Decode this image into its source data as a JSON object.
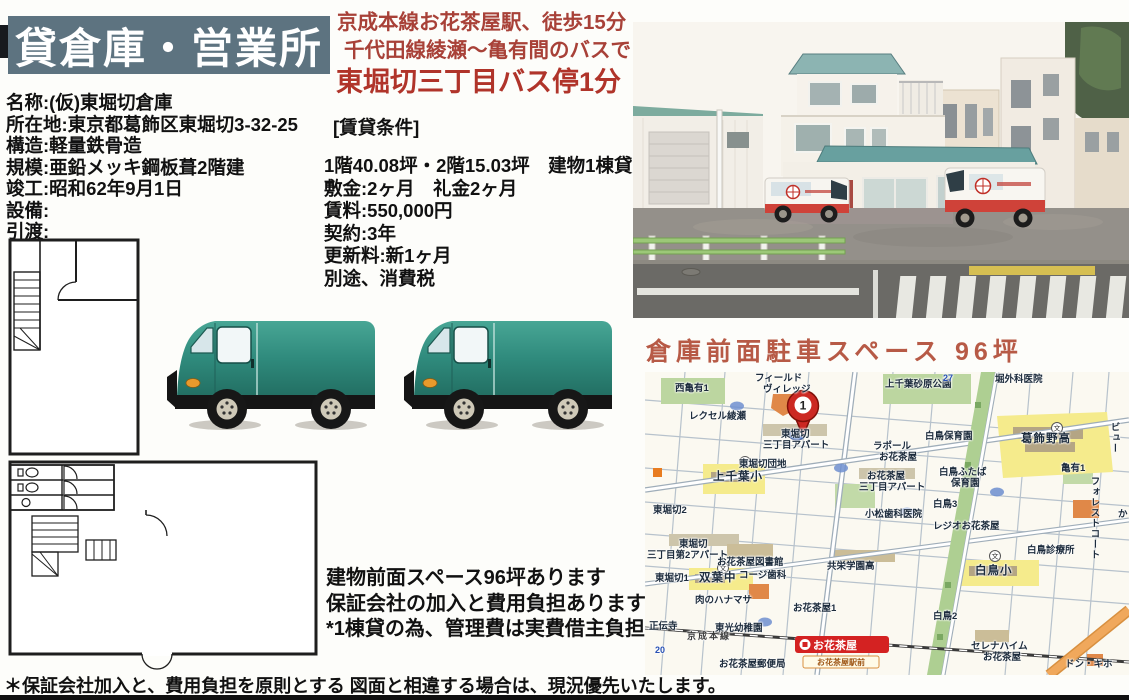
{
  "colors": {
    "banner_bg": "#5d7380",
    "heading_red": "#a84138",
    "title_red": "#b0342a",
    "parking_red": "#b75a46",
    "station_red": "#d42222",
    "van_teal": "#2f8a7c",
    "roof_teal": "#6ba09f"
  },
  "banner": {
    "title": "貸倉庫・営業所"
  },
  "property": {
    "lines": [
      "名称:(仮)東堀切倉庫",
      "所在地:東京都葛飾区東堀切3-32-25",
      "構造:軽量鉄骨造",
      "規模:亜鉛メッキ鋼板葺2階建",
      "竣工:昭和62年9月1日",
      "設備:",
      "引渡:"
    ]
  },
  "access": {
    "line1": "京成本線お花茶屋駅、徒歩15分",
    "line2": "千代田線綾瀬～亀有間のバスで",
    "line3": "東堀切三丁目バス停1分",
    "lease_heading": "[賃貸条件]"
  },
  "lease": {
    "lines": [
      "1階40.08坪・2階15.03坪　建物1棟貸",
      "敷金:2ヶ月　礼金2ヶ月",
      "賃料:550,000円",
      "契約:3年",
      "更新料:新1ヶ月",
      "別途、消費税"
    ]
  },
  "notes": {
    "lines": [
      "建物前面スペース96坪あります",
      "保証会社の加入と費用負担あります",
      "*1棟貸の為、管理費は実費借主負担"
    ]
  },
  "parking_title": "倉庫前面駐車スペース 96坪",
  "footer": "＊保証会社加入と、費用負担を原則とする 図面と相違する場合は、現況優先いたします。",
  "map": {
    "marker": "1",
    "station_label": "お花茶屋",
    "busstop_label": "お花茶屋駅前",
    "labels": [
      {
        "text": "西亀有1",
        "x": 30,
        "y": 12
      },
      {
        "text": "フィールド",
        "x": 110,
        "y": 2
      },
      {
        "text": "ヴィレッジ",
        "x": 118,
        "y": 13
      },
      {
        "text": "上千葉砂原公園",
        "x": 240,
        "y": 8
      },
      {
        "text": "堀外科医院",
        "x": 350,
        "y": 3
      },
      {
        "text": "レクセル綾瀬",
        "x": 44,
        "y": 40
      },
      {
        "text": "東堀切",
        "x": 136,
        "y": 58
      },
      {
        "text": "三丁目アパート",
        "x": 118,
        "y": 69
      },
      {
        "text": "東堀切団地",
        "x": 94,
        "y": 88
      },
      {
        "text": "上千葉小",
        "x": 68,
        "y": 100,
        "cls": "big"
      },
      {
        "text": "ラポール",
        "x": 228,
        "y": 70
      },
      {
        "text": "お花茶屋",
        "x": 234,
        "y": 81
      },
      {
        "text": "白鳥保育園",
        "x": 280,
        "y": 60
      },
      {
        "text": "葛飾野高",
        "x": 376,
        "y": 62,
        "cls": "big"
      },
      {
        "text": "亀有1",
        "x": 416,
        "y": 92
      },
      {
        "text": "白鳥ふたば",
        "x": 294,
        "y": 96
      },
      {
        "text": "保育園",
        "x": 306,
        "y": 107
      },
      {
        "text": "フォレストコート",
        "x": 444,
        "y": 104,
        "cls": "vert"
      },
      {
        "text": "ビュー",
        "x": 464,
        "y": 50,
        "cls": "vert"
      },
      {
        "text": "か",
        "x": 473,
        "y": 138
      },
      {
        "text": "東堀切2",
        "x": 8,
        "y": 134
      },
      {
        "text": "白鳥3",
        "x": 288,
        "y": 128
      },
      {
        "text": "小松歯科医院",
        "x": 220,
        "y": 138
      },
      {
        "text": "レジオお花茶屋",
        "x": 288,
        "y": 150
      },
      {
        "text": "お花茶屋",
        "x": 222,
        "y": 100
      },
      {
        "text": "三丁目アパート",
        "x": 214,
        "y": 111
      },
      {
        "text": "東堀切",
        "x": 34,
        "y": 168
      },
      {
        "text": "三丁目第2アパート",
        "x": 2,
        "y": 179
      },
      {
        "text": "お花茶屋図書館",
        "x": 72,
        "y": 186
      },
      {
        "text": "コージ歯科",
        "x": 94,
        "y": 199
      },
      {
        "text": "共栄学園高",
        "x": 182,
        "y": 190
      },
      {
        "text": "東堀切1",
        "x": 10,
        "y": 202
      },
      {
        "text": "双葉中",
        "x": 54,
        "y": 201,
        "cls": "big"
      },
      {
        "text": "肉のハナマサ",
        "x": 50,
        "y": 224
      },
      {
        "text": "白鳥小",
        "x": 330,
        "y": 194,
        "cls": "big"
      },
      {
        "text": "白鳥診療所",
        "x": 382,
        "y": 174
      },
      {
        "text": "お花茶屋1",
        "x": 148,
        "y": 232
      },
      {
        "text": "白鳥2",
        "x": 288,
        "y": 240
      },
      {
        "text": "正伝寺",
        "x": 4,
        "y": 250
      },
      {
        "text": "東光幼稚園",
        "x": 70,
        "y": 252
      },
      {
        "text": "京成本線",
        "x": 42,
        "y": 260,
        "cls": "rail"
      },
      {
        "text": "お花茶屋郵便局",
        "x": 74,
        "y": 288
      },
      {
        "text": "セレナハイム",
        "x": 326,
        "y": 270
      },
      {
        "text": "お花茶屋",
        "x": 338,
        "y": 281
      },
      {
        "text": "ドン・キホ",
        "x": 420,
        "y": 288
      },
      {
        "text": "27",
        "x": 298,
        "y": 2,
        "cls": "blue"
      },
      {
        "text": "20",
        "x": 10,
        "y": 274,
        "cls": "blue"
      }
    ]
  }
}
